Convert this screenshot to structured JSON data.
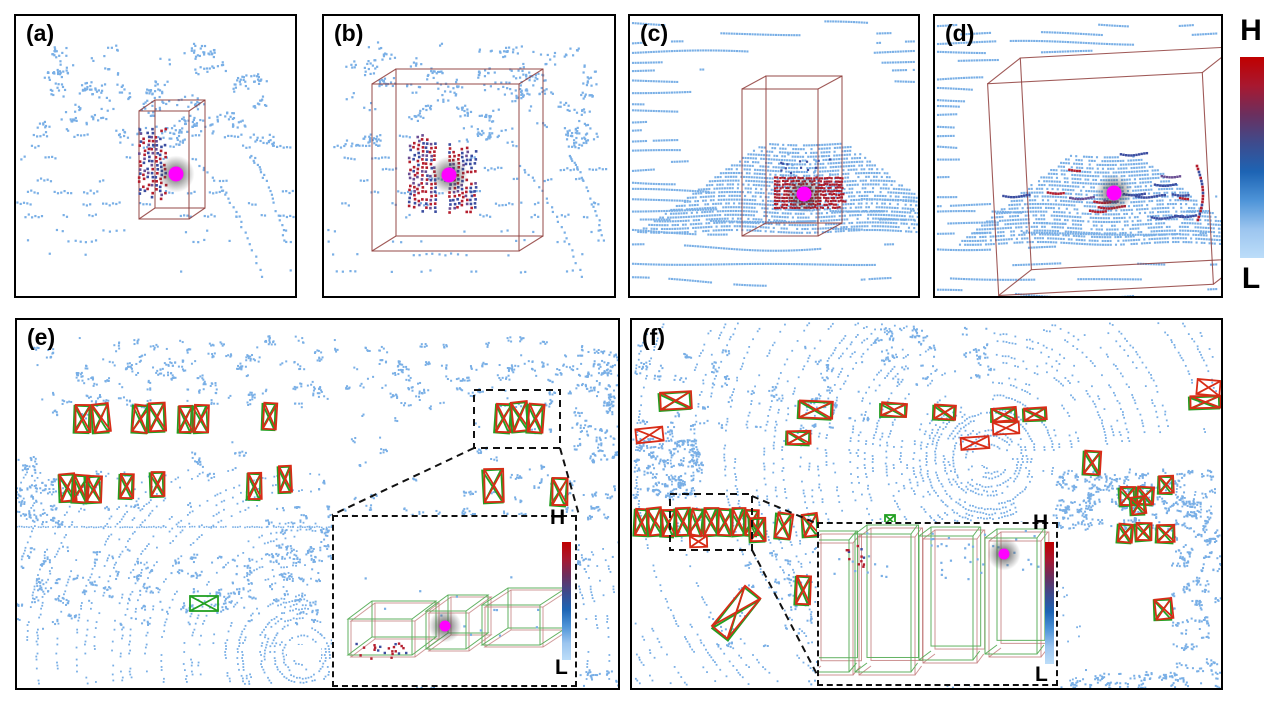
{
  "figure": {
    "description": "LiDAR point cloud qualitative results with 3D bounding boxes and BEV detections"
  },
  "colorbar": {
    "high_label": "H",
    "low_label": "L",
    "gradient": [
      "#C00000",
      "#A81830",
      "#6B2F5E",
      "#3E4B8D",
      "#1D64B4",
      "#4E94D8",
      "#9CC5EF",
      "#BCDDF9"
    ]
  },
  "colors": {
    "point_blue": "#79AFE6",
    "hot_red": "#B41E2E",
    "deep_red": "#C00000",
    "mid_blue": "#3B4DA0",
    "mid_purple": "#6A4E93",
    "wire_red": "#8F3D3B",
    "gt_green": "#22A022",
    "pred_red": "#D82C17",
    "marker_magenta": "#FF00FF",
    "inset_green": "#5AAE5A",
    "inset_red": "#C07878",
    "dash_black": "#111111",
    "ego_white": "#FFFFFF"
  },
  "panels": {
    "a": {
      "label": "(a)",
      "type": "perspective",
      "bg": "sparse",
      "seed": 101,
      "box3d": {
        "front": [
          123,
          95,
          50,
          108
        ],
        "off": [
          16,
          -11
        ]
      },
      "object": "stripes1",
      "marker": [
        160,
        158
      ]
    },
    "b": {
      "label": "(b)",
      "type": "perspective",
      "bg": "sparse",
      "seed": 202,
      "box3d": {
        "front": [
          48,
          68,
          147,
          167
        ],
        "off": [
          24,
          -15
        ]
      },
      "object": "stripes2",
      "marker": [
        125,
        159
      ]
    },
    "c": {
      "label": "(c)",
      "type": "perspective",
      "bg": "lines",
      "seed": 303,
      "occl": [
        165,
        112,
        118,
        76
      ],
      "car": [
        175,
        128,
        216,
        40,
        1.45
      ],
      "box3d": {
        "front": [
          112,
          73,
          76,
          147
        ],
        "off": [
          24,
          -13
        ]
      },
      "object": "patch",
      "marker": [
        174,
        178
      ]
    },
    "d": {
      "label": "(d)",
      "type": "perspective",
      "bg": "lines",
      "seed": 404,
      "occl": [
        160,
        118,
        140,
        92
      ],
      "car": [
        170,
        140,
        210,
        34,
        1.3
      ],
      "box3d": {
        "front": [
          58,
          62,
          215,
          212
        ],
        "off": [
          34,
          -24
        ],
        "rot": -3
      },
      "object": "segments",
      "marker": [
        179,
        177
      ]
    },
    "e": {
      "label": "(e)",
      "type": "bev",
      "seed": 505,
      "ego": [
        285,
        335
      ],
      "maxR": 380,
      "wedgeMinR": 46,
      "wedges": [
        [
          -1.45,
          -0.35
        ]
      ],
      "clipYmin": 150,
      "clipR": 90,
      "egoRect": [
        270,
        325,
        34,
        15
      ],
      "hline": [
        0,
        445,
        207
      ],
      "clutter": [
        [
          15,
          18,
          580,
          30,
          70
        ],
        [
          25,
          42,
          570,
          45,
          130
        ],
        [
          0,
          135,
          45,
          70,
          40
        ],
        [
          250,
          185,
          210,
          55,
          90
        ],
        [
          0,
          228,
          310,
          80,
          130
        ],
        [
          455,
          150,
          150,
          100,
          40
        ],
        [
          560,
          30,
          45,
          110,
          60
        ],
        [
          330,
          352,
          270,
          14,
          40
        ],
        [
          0,
          80,
          605,
          110,
          50
        ]
      ],
      "boxes": [
        [
          57,
          86,
          15,
          27,
          2,
          "pair"
        ],
        [
          75,
          85,
          16,
          28,
          -3,
          "pair"
        ],
        [
          115,
          86,
          15,
          27,
          3,
          "pair"
        ],
        [
          131,
          84,
          16,
          28,
          -2,
          "pair"
        ],
        [
          161,
          87,
          13,
          26,
          2,
          "pair"
        ],
        [
          176,
          86,
          14,
          27,
          -3,
          "pair"
        ],
        [
          245,
          84,
          13,
          26,
          2,
          "pair"
        ],
        [
          42,
          155,
          15,
          27,
          -2,
          "pair"
        ],
        [
          55,
          156,
          15,
          27,
          3,
          "pair"
        ],
        [
          68,
          157,
          15,
          26,
          -3,
          "pair"
        ],
        [
          102,
          155,
          13,
          24,
          2,
          "pair"
        ],
        [
          133,
          153,
          13,
          24,
          -2,
          "pair"
        ],
        [
          230,
          154,
          13,
          26,
          2,
          "pair"
        ],
        [
          261,
          147,
          12,
          26,
          -2,
          "pair"
        ],
        [
          478,
          85,
          15,
          28,
          4,
          "pair"
        ],
        [
          494,
          83,
          16,
          29,
          -5,
          "pair"
        ],
        [
          510,
          85,
          15,
          28,
          3,
          "pair"
        ],
        [
          466,
          150,
          19,
          33,
          -3,
          "pair"
        ],
        [
          534,
          159,
          15,
          27,
          4,
          "pair"
        ],
        [
          173,
          276,
          28,
          15,
          0,
          "green"
        ]
      ],
      "zoom_rect": [
        457,
        70,
        86,
        58
      ],
      "connectors": [
        [
          457,
          128,
          315,
          195
        ],
        [
          543,
          128,
          562,
          195
        ]
      ],
      "inset": {
        "high_label": "H",
        "low_label": "L",
        "style": "slabs",
        "marker": [
          111,
          109
        ],
        "slabs": [
          {
            "x": 14,
            "y": 138,
            "w": 64,
            "skx": 24,
            "sky": -18,
            "hz": 36
          },
          {
            "x": 92,
            "y": 132,
            "w": 40,
            "skx": 22,
            "sky": -16,
            "hz": 38
          },
          {
            "x": 148,
            "y": 128,
            "w": 58,
            "skx": 26,
            "sky": -17,
            "hz": 40
          }
        ]
      }
    },
    "f": {
      "label": "(f)",
      "type": "bev",
      "seed": 606,
      "ego": [
        358,
        139
      ],
      "maxR": 420,
      "wedgeMinR": 50,
      "wedges": [
        [
          0.25,
          1.05
        ],
        [
          -0.12,
          0.14
        ],
        [
          -2.05,
          -1.55
        ]
      ],
      "clipYmin": null,
      "clipR": 0,
      "egoRect": [
        342,
        131,
        30,
        14
      ],
      "hline": null,
      "clutter": [
        [
          0,
          25,
          240,
          95,
          60
        ],
        [
          0,
          118,
          70,
          60,
          90
        ],
        [
          420,
          150,
          160,
          60,
          150
        ],
        [
          80,
          230,
          180,
          100,
          40
        ],
        [
          540,
          200,
          50,
          170,
          80
        ],
        [
          180,
          335,
          200,
          32,
          50
        ],
        [
          300,
          352,
          290,
          16,
          60
        ],
        [
          240,
          5,
          120,
          60,
          40
        ]
      ],
      "boxes": [
        [
          27,
          73,
          31,
          17,
          -4,
          "pair"
        ],
        [
          4,
          108,
          27,
          14,
          -6,
          "red"
        ],
        [
          166,
          82,
          33,
          17,
          3,
          "pair"
        ],
        [
          154,
          112,
          23,
          13,
          2,
          "pair"
        ],
        [
          248,
          84,
          25,
          13,
          0,
          "pair"
        ],
        [
          301,
          86,
          21,
          14,
          2,
          "pair"
        ],
        [
          359,
          89,
          24,
          13,
          0,
          "pair"
        ],
        [
          391,
          89,
          22,
          12,
          -2,
          "pair"
        ],
        [
          361,
          102,
          26,
          12,
          -3,
          "red"
        ],
        [
          329,
          117,
          28,
          12,
          -4,
          "red"
        ],
        [
          565,
          60,
          23,
          15,
          5,
          "red"
        ],
        [
          557,
          77,
          30,
          12,
          -2,
          "pair"
        ],
        [
          451,
          132,
          16,
          23,
          3,
          "pair"
        ],
        [
          487,
          168,
          15,
          18,
          -4,
          "pair"
        ],
        [
          504,
          168,
          16,
          17,
          3,
          "pair"
        ],
        [
          526,
          157,
          14,
          17,
          2,
          "pair"
        ],
        [
          2,
          190,
          13,
          26,
          3,
          "pair"
        ],
        [
          15,
          189,
          14,
          27,
          -4,
          "pair"
        ],
        [
          29,
          191,
          13,
          26,
          4,
          "pair"
        ],
        [
          43,
          189,
          14,
          27,
          -3,
          "pair"
        ],
        [
          57,
          190,
          13,
          26,
          5,
          "pair"
        ],
        [
          71,
          189,
          14,
          27,
          -4,
          "pair"
        ],
        [
          85,
          190,
          14,
          26,
          3,
          "pair"
        ],
        [
          99,
          189,
          13,
          27,
          -5,
          "pair"
        ],
        [
          112,
          191,
          13,
          25,
          4,
          "pair"
        ],
        [
          58,
          216,
          17,
          11,
          -2,
          "red"
        ],
        [
          117,
          199,
          15,
          23,
          -3,
          "pair"
        ],
        [
          143,
          194,
          15,
          25,
          4,
          "pair"
        ],
        [
          170,
          195,
          15,
          22,
          -3,
          "pair"
        ],
        [
          253,
          195,
          10,
          9,
          0,
          "green"
        ],
        [
          163,
          257,
          14,
          28,
          3,
          "pair"
        ],
        [
          78,
          284,
          52,
          20,
          -52,
          "pair"
        ],
        [
          498,
          178,
          14,
          17,
          -3,
          "pair"
        ],
        [
          485,
          205,
          14,
          18,
          4,
          "pair"
        ],
        [
          503,
          204,
          15,
          17,
          -4,
          "pair"
        ],
        [
          524,
          206,
          17,
          17,
          3,
          "pair"
        ],
        [
          522,
          280,
          17,
          20,
          -2,
          "pair"
        ]
      ],
      "zoom_rect": [
        38,
        174,
        82,
        56
      ],
      "connectors": [
        [
          120,
          176,
          186,
          204
        ],
        [
          120,
          230,
          188,
          360
        ]
      ],
      "inset": {
        "high_label": "H",
        "low_label": "L",
        "style": "tall",
        "marker": [
          185,
          30
        ],
        "tall": [
          {
            "x": -14,
            "y": 16,
            "w": 44,
            "h": 132
          },
          {
            "x": 36,
            "y": 10,
            "w": 56,
            "h": 138
          },
          {
            "x": 100,
            "y": 12,
            "w": 54,
            "h": 124
          },
          {
            "x": 166,
            "y": 14,
            "w": 52,
            "h": 116
          }
        ]
      }
    }
  }
}
